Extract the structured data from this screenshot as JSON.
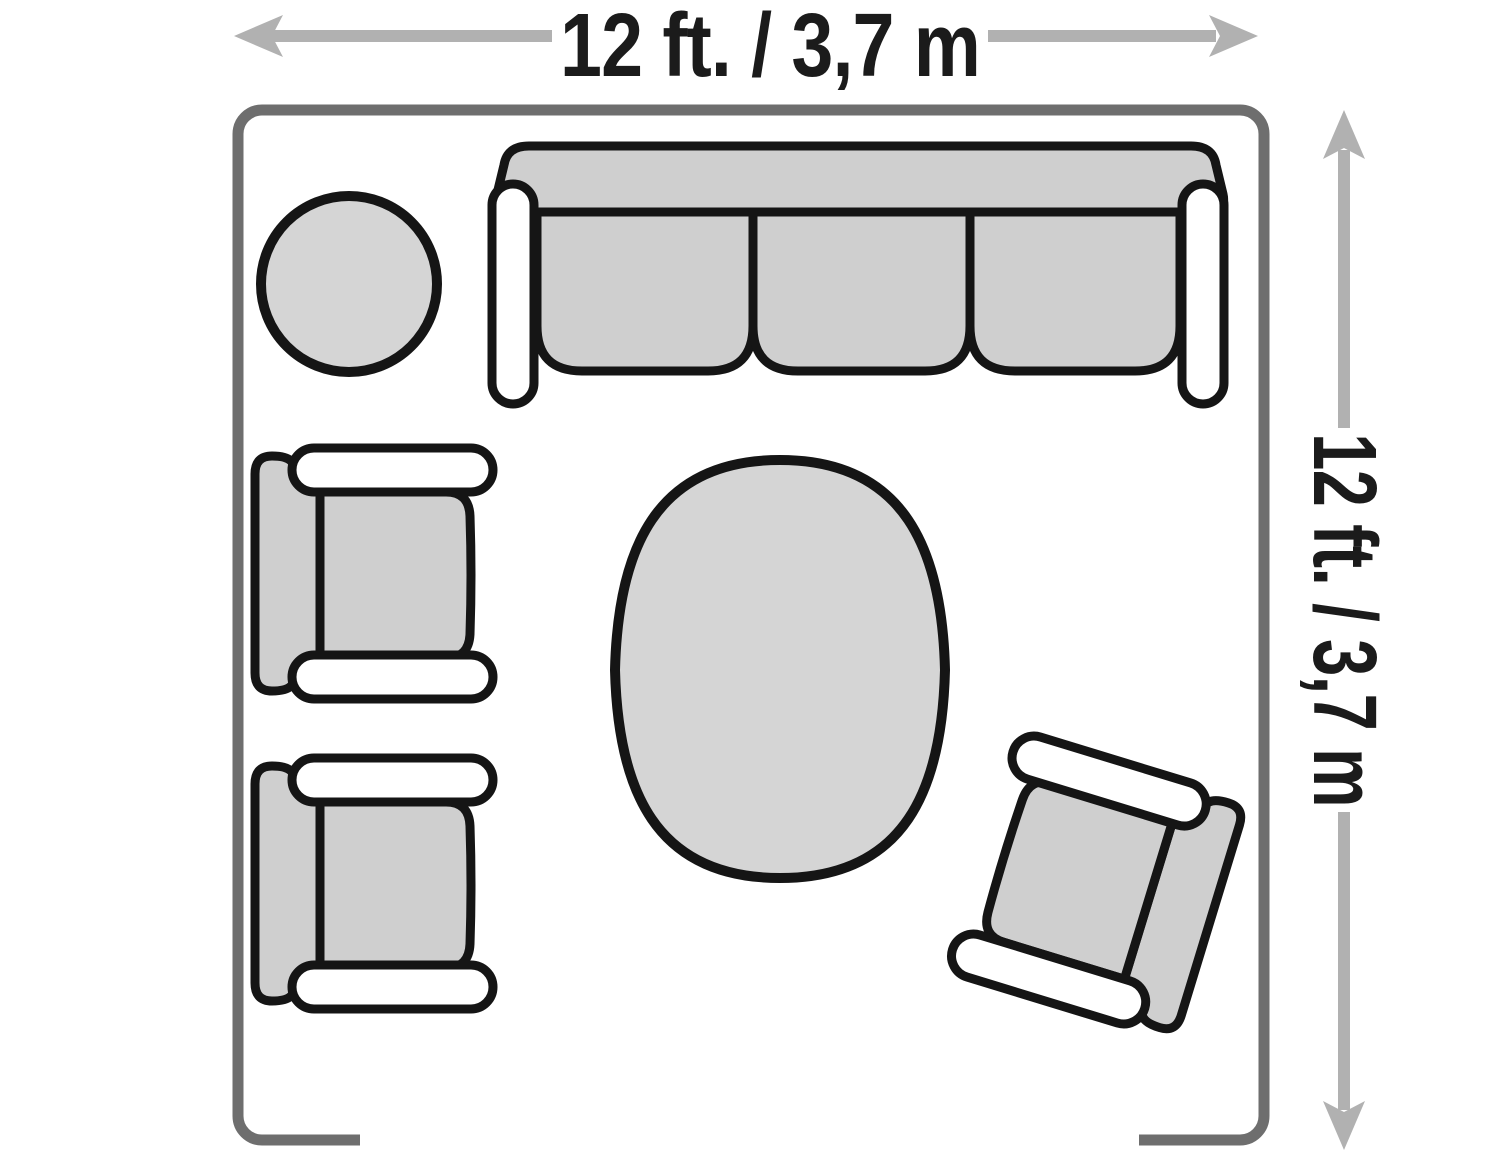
{
  "diagram": {
    "type": "floor-plan",
    "room": {
      "name": "living-room",
      "shape": "rounded-square",
      "wall_opening": "bottom-center"
    },
    "dimensions": {
      "top": {
        "label": "12 ft. / 3,7 m",
        "orientation": "horizontal"
      },
      "right": {
        "label": "12 ft. / 3,7 m",
        "orientation": "vertical"
      }
    },
    "furniture": [
      {
        "name": "round-side-table"
      },
      {
        "name": "three-seat-sofa",
        "cushions": 3
      },
      {
        "name": "armchair-upper-left"
      },
      {
        "name": "armchair-lower-left"
      },
      {
        "name": "oval-coffee-table"
      },
      {
        "name": "armchair-angled-bottom-right"
      }
    ],
    "colors": {
      "wall": "#6e6e6e",
      "arrow": "#b1b1b1",
      "outline": "#151515",
      "upholstery_fill": "#cfcfcf",
      "table_fill": "#d5d5d5",
      "armrest_fill": "#ffffff",
      "background": "#ffffff",
      "label_text": "#1b1b1b"
    }
  }
}
